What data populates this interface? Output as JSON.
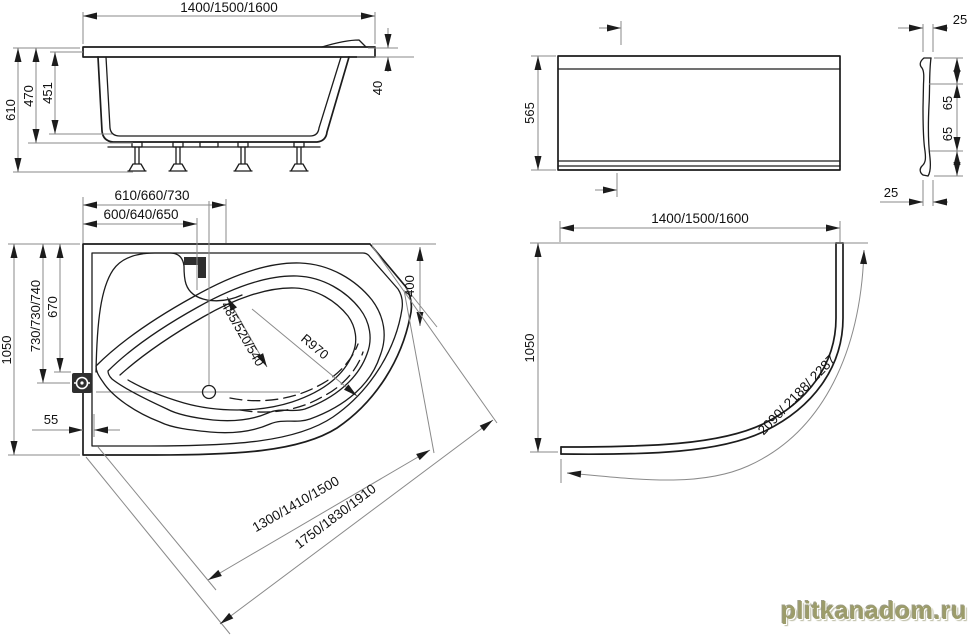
{
  "colors": {
    "object_line": "#1c1c1c",
    "dimension_line": "#8a8a8a",
    "text": "#111111",
    "icon_fill": "#2e2e2e",
    "watermark": "#9c9c6a",
    "background": "#ffffff"
  },
  "watermark": {
    "text": "plitkanadom.ru"
  },
  "views": {
    "side": {
      "dims": {
        "width": "1400/1500/1600",
        "total_height": "610",
        "body_height": "470",
        "inner_depth": "451",
        "rim_height": "40"
      }
    },
    "apron_front": {
      "dims": {
        "height": "565",
        "top_gap": "25",
        "bottom_gap": "25",
        "hook_upper": "65",
        "hook_lower": "65"
      }
    },
    "plan": {
      "dims": {
        "top_outer": "610/660/730",
        "top_inner": "600/640/650",
        "height": "1050",
        "left_outer": "730/730/740",
        "left_inner": "670",
        "side_offset": "55",
        "waist": "485/520/540",
        "radius": "R970",
        "corner_edge": "400",
        "diagonal_inner": "1300/1410/1500",
        "diagonal_outer": "1750/1830/1910"
      }
    },
    "apron_plan": {
      "dims": {
        "width": "1400/1500/1600",
        "height": "1050",
        "arc_length": "2090/ 2188/ 2287"
      }
    }
  }
}
